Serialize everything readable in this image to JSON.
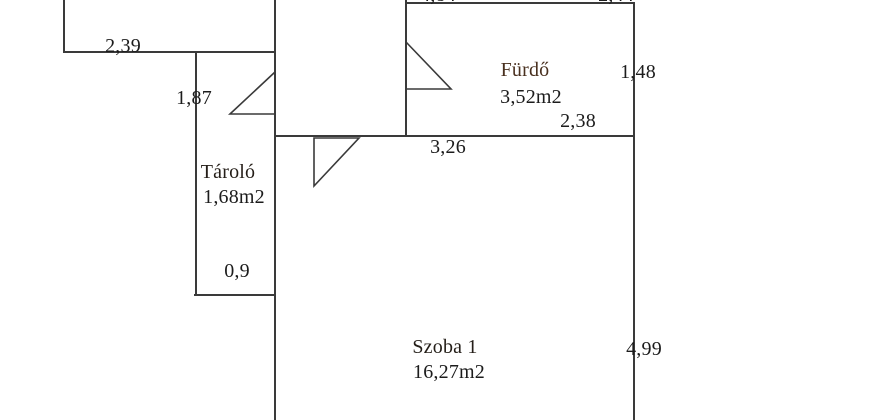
{
  "colors": {
    "background": "#ffffff",
    "wall": "#3a3a3a",
    "text": "#1c1c1c",
    "room_name": "#49301f"
  },
  "icons": {
    "door_swing": "open-door-triangle"
  },
  "rooms": {
    "furdo": {
      "name": "Fürdő",
      "area": "3,52m2"
    },
    "tarolo": {
      "name": "Tároló",
      "area": "1,68m2"
    },
    "szoba1": {
      "name": "Szoba 1",
      "area": "16,27m2"
    }
  },
  "dimensions": {
    "topleft_room_width": "2,39",
    "tarolo_wall_height": "1,87",
    "tarolo_bottom_width": "0,9",
    "szoba1_top_width": "3,26",
    "furdo_bottom_width": "2,38",
    "furdo_right_height": "1,48",
    "szoba1_right_height": "4,99",
    "top_edge_cut_left": "4,84",
    "top_edge_cut_right": "2,44"
  }
}
